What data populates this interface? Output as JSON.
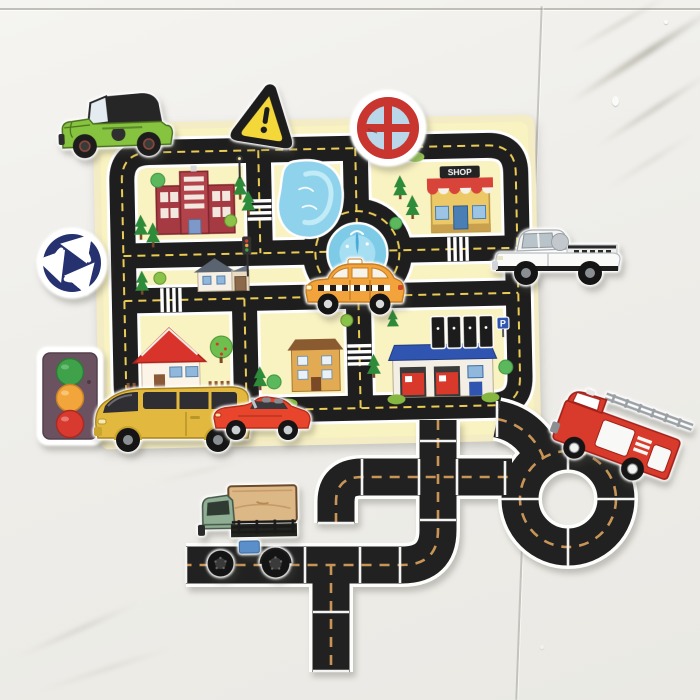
{
  "scene": {
    "description": "Photo of a children's foam traffic play set stuck on a white marble-tiled bathroom wall: a yellow city road mat, foam vehicle and road-sign stickers, and black puzzle road-track pieces arranged below it",
    "wall": {
      "tile_color": "#f0efeb",
      "seam_color": "#96938a",
      "marble_vein_color": "#8c8773",
      "tile_seams": [
        "horizontal seam near top",
        "vertical seam on right side"
      ]
    }
  },
  "mat": {
    "background_color": "#f8f1c2",
    "road_color": "#1e1e1e",
    "lane_dash_color": "#e9cb55",
    "curb_color": "#ffffff",
    "shop_sign_text": "SHOP",
    "parking_sign_text": "P",
    "features": [
      "perimeter ring road",
      "central roundabout with blue fountain",
      "lake",
      "red hospital building",
      "shop with striped awning",
      "gray-roof house with garage",
      "red-roof house with fence and apple tree",
      "tan apartment building",
      "fire station with blue roof",
      "four black parking bays",
      "zebra crossings",
      "pine and round trees",
      "mini traffic light",
      "street lamp"
    ]
  },
  "stickers": [
    {
      "id": "jeep",
      "label": "green jeep with black soft top",
      "color": "#86c33e"
    },
    {
      "id": "warning-sign",
      "label": "yellow triangle warning sign with exclamation mark",
      "color": "#f4d83a"
    },
    {
      "id": "no-entry-sign",
      "label": "red circular sign with cross on light-blue field",
      "color": "#c9352f"
    },
    {
      "id": "roundabout-sign",
      "label": "navy circular roundabout sign with three white arrows",
      "color": "#26316f"
    },
    {
      "id": "traffic-light",
      "label": "traffic light with green, amber and red lamps",
      "color": "#6a5260"
    },
    {
      "id": "pickup-truck",
      "label": "white pickup truck",
      "color": "#f4f4f2"
    },
    {
      "id": "taxi",
      "label": "orange taxi with checker band",
      "color": "#f2a33c"
    },
    {
      "id": "van",
      "label": "yellow panel van",
      "color": "#e2b93e"
    },
    {
      "id": "sports-car",
      "label": "red open-top sports car",
      "color": "#e8452c"
    },
    {
      "id": "cargo-truck",
      "label": "green flatbed truck carrying a tan crate",
      "color": "#8fae94"
    },
    {
      "id": "fire-truck",
      "label": "red fire engine with ladder, tilted on the loop",
      "color": "#d83a2c"
    }
  ],
  "track": {
    "road_color": "#212121",
    "edge_color": "#fdfdfc",
    "dash_color": "#c89557",
    "pieces": [
      "straights",
      "curves",
      "T-junction",
      "crossroad",
      "closed loop",
      "dead-end stubs"
    ]
  }
}
